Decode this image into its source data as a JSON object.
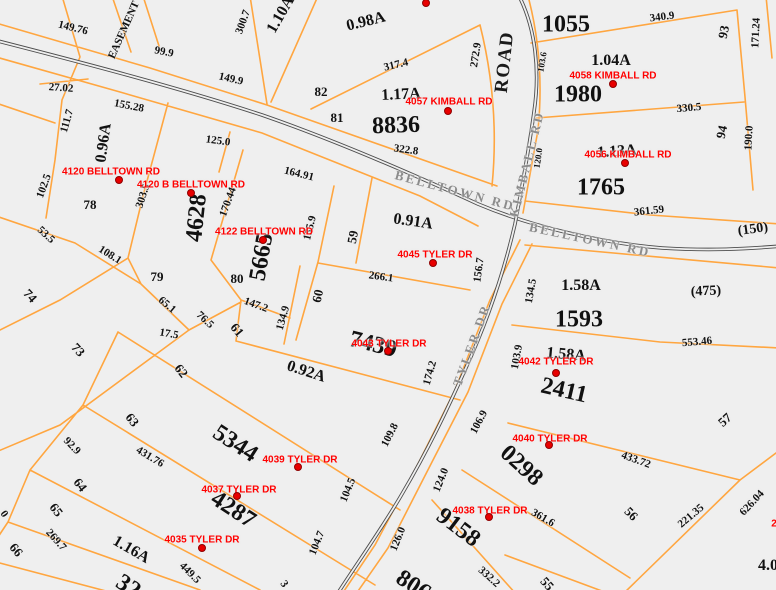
{
  "title": "Parcel tax map",
  "map": {
    "background": "#efefef",
    "colors": {
      "parcel_line": "#ffa640",
      "road_line": "#4c4c4c",
      "road_label": "#8c8c8c",
      "address": "#ff0000",
      "label": "#111111"
    },
    "road_names": [
      "BELLTOWN RD",
      "KIMBALL RD",
      "TYLER DR",
      "ROAD"
    ],
    "labels": [
      {
        "t": "149.76",
        "x": 73,
        "y": 28,
        "r": 14,
        "k": "dim"
      },
      {
        "t": "EASEMENT",
        "x": 124,
        "y": 30,
        "r": -66,
        "k": "dim"
      },
      {
        "t": "99.9",
        "x": 164,
        "y": 52,
        "r": 11,
        "k": "dim"
      },
      {
        "t": "149.9",
        "x": 231,
        "y": 79,
        "r": 13,
        "k": "dim"
      },
      {
        "t": "27.02",
        "x": 61,
        "y": 88,
        "r": 4,
        "k": "dim"
      },
      {
        "t": "155.28",
        "x": 129,
        "y": 106,
        "r": 11,
        "k": "dim"
      },
      {
        "t": "111.7",
        "x": 67,
        "y": 121,
        "r": -74,
        "k": "dim"
      },
      {
        "t": "0.96A",
        "x": 104,
        "y": 143,
        "r": -82,
        "k": "acre"
      },
      {
        "t": "125.0",
        "x": 218,
        "y": 141,
        "r": 8,
        "k": "dim"
      },
      {
        "t": "102.5",
        "x": 44,
        "y": 186,
        "r": -70,
        "k": "dim"
      },
      {
        "t": "300.7",
        "x": 243,
        "y": 22,
        "r": -70,
        "k": "dim"
      },
      {
        "t": "1.10A",
        "x": 281,
        "y": 15,
        "r": -60,
        "k": "acre"
      },
      {
        "t": "0.98A",
        "x": 366,
        "y": 22,
        "r": -14,
        "k": "acre"
      },
      {
        "t": "317.4",
        "x": 396,
        "y": 65,
        "r": -13,
        "k": "dim"
      },
      {
        "t": "272.9",
        "x": 476,
        "y": 55,
        "r": -81,
        "k": "dim"
      },
      {
        "t": "ROAD",
        "x": 505,
        "y": 62,
        "r": -84,
        "k": "roadbig"
      },
      {
        "t": "82",
        "x": 321,
        "y": 92,
        "r": 0,
        "k": "lot"
      },
      {
        "t": "1.17A",
        "x": 401,
        "y": 95,
        "r": -3,
        "k": "acre"
      },
      {
        "t": "81",
        "x": 337,
        "y": 118,
        "r": 0,
        "k": "lot"
      },
      {
        "t": "8836",
        "x": 396,
        "y": 126,
        "r": -2,
        "k": "parcel"
      },
      {
        "t": "322.8",
        "x": 406,
        "y": 150,
        "r": 8,
        "k": "dim"
      },
      {
        "t": "164.91",
        "x": 299,
        "y": 174,
        "r": 14,
        "k": "dim"
      },
      {
        "t": "BELLTOWN RD",
        "x": 455,
        "y": 191,
        "r": 15,
        "k": "road"
      },
      {
        "t": "1055",
        "x": 566,
        "y": 25,
        "r": 0,
        "k": "parcel"
      },
      {
        "t": "340.9",
        "x": 662,
        "y": 17,
        "r": -7,
        "k": "dim"
      },
      {
        "t": "93",
        "x": 724,
        "y": 32,
        "r": -78,
        "k": "lot"
      },
      {
        "t": "171.24",
        "x": 756,
        "y": 33,
        "r": -87,
        "k": "dim"
      },
      {
        "t": "1.04A",
        "x": 611,
        "y": 61,
        "r": 0,
        "k": "acre"
      },
      {
        "t": "1980",
        "x": 578,
        "y": 95,
        "r": 0,
        "k": "parcel"
      },
      {
        "t": "330.5",
        "x": 689,
        "y": 108,
        "r": -5,
        "k": "dim"
      },
      {
        "t": "103.6",
        "x": 542,
        "y": 62,
        "r": -80,
        "k": "dimsm"
      },
      {
        "t": "94",
        "x": 722,
        "y": 132,
        "r": -78,
        "k": "lot"
      },
      {
        "t": "190.0",
        "x": 749,
        "y": 138,
        "r": -87,
        "k": "dim"
      },
      {
        "t": "1.13A",
        "x": 617,
        "y": 152,
        "r": -4,
        "k": "acre"
      },
      {
        "t": "1765",
        "x": 601,
        "y": 188,
        "r": 0,
        "k": "parcel"
      },
      {
        "t": "KIMBALL RD",
        "x": 527,
        "y": 164,
        "r": -76,
        "k": "road"
      },
      {
        "t": "120.0",
        "x": 538,
        "y": 158,
        "r": -82,
        "k": "dimsm"
      },
      {
        "t": "361.59",
        "x": 649,
        "y": 211,
        "r": -6,
        "k": "dim"
      },
      {
        "t": "BELLTOWN RD",
        "x": 590,
        "y": 240,
        "r": 12,
        "k": "road"
      },
      {
        "t": "(150)",
        "x": 753,
        "y": 230,
        "r": -8,
        "k": "paren"
      },
      {
        "t": "78",
        "x": 90,
        "y": 205,
        "r": 0,
        "k": "lot"
      },
      {
        "t": "303.5",
        "x": 143,
        "y": 196,
        "r": -72,
        "k": "dim"
      },
      {
        "t": "4628",
        "x": 197,
        "y": 218,
        "r": -84,
        "k": "parcel"
      },
      {
        "t": "170.44",
        "x": 228,
        "y": 202,
        "r": -70,
        "k": "dim"
      },
      {
        "t": "53.5",
        "x": 46,
        "y": 235,
        "r": 42,
        "k": "dim"
      },
      {
        "t": "108.1",
        "x": 110,
        "y": 255,
        "r": 32,
        "k": "dim"
      },
      {
        "t": "79",
        "x": 157,
        "y": 277,
        "r": 0,
        "k": "lot"
      },
      {
        "t": "74",
        "x": 30,
        "y": 296,
        "r": 48,
        "k": "lot"
      },
      {
        "t": "80",
        "x": 237,
        "y": 279,
        "r": 0,
        "k": "lot"
      },
      {
        "t": "5665",
        "x": 262,
        "y": 257,
        "r": -80,
        "k": "parcel"
      },
      {
        "t": "155.9",
        "x": 310,
        "y": 228,
        "r": -76,
        "k": "dim"
      },
      {
        "t": "59",
        "x": 353,
        "y": 237,
        "r": -80,
        "k": "lot"
      },
      {
        "t": "0.91A",
        "x": 413,
        "y": 222,
        "r": 8,
        "k": "acre"
      },
      {
        "t": "156.7",
        "x": 479,
        "y": 270,
        "r": -82,
        "k": "dim"
      },
      {
        "t": "266.1",
        "x": 381,
        "y": 277,
        "r": 8,
        "k": "dim"
      },
      {
        "t": "147.2",
        "x": 256,
        "y": 305,
        "r": 20,
        "k": "dim"
      },
      {
        "t": "134.9",
        "x": 283,
        "y": 318,
        "r": -74,
        "k": "dim"
      },
      {
        "t": "60",
        "x": 318,
        "y": 296,
        "r": -78,
        "k": "lot"
      },
      {
        "t": "65.1",
        "x": 167,
        "y": 305,
        "r": 40,
        "k": "dim"
      },
      {
        "t": "76.5",
        "x": 205,
        "y": 320,
        "r": 43,
        "k": "dim"
      },
      {
        "t": "17.5",
        "x": 169,
        "y": 334,
        "r": 10,
        "k": "dim"
      },
      {
        "t": "61",
        "x": 237,
        "y": 330,
        "r": 50,
        "k": "lot"
      },
      {
        "t": "73",
        "x": 78,
        "y": 350,
        "r": 48,
        "k": "lot"
      },
      {
        "t": "62",
        "x": 181,
        "y": 371,
        "r": 52,
        "k": "lot"
      },
      {
        "t": "7439",
        "x": 373,
        "y": 345,
        "r": 14,
        "k": "parcel"
      },
      {
        "t": "174.2",
        "x": 430,
        "y": 373,
        "r": -74,
        "k": "dim"
      },
      {
        "t": "TYLER DR",
        "x": 472,
        "y": 345,
        "r": -70,
        "k": "road"
      },
      {
        "t": "0.92A",
        "x": 306,
        "y": 372,
        "r": 18,
        "k": "acre"
      },
      {
        "t": "134.5",
        "x": 531,
        "y": 291,
        "r": -80,
        "k": "dim"
      },
      {
        "t": "1.58A",
        "x": 581,
        "y": 286,
        "r": 0,
        "k": "acre"
      },
      {
        "t": "(475)",
        "x": 706,
        "y": 292,
        "r": -3,
        "k": "paren"
      },
      {
        "t": "1593",
        "x": 579,
        "y": 320,
        "r": 0,
        "k": "parcel"
      },
      {
        "t": "553.46",
        "x": 697,
        "y": 342,
        "r": -5,
        "k": "dim"
      },
      {
        "t": "103.9",
        "x": 517,
        "y": 357,
        "r": -80,
        "k": "dim"
      },
      {
        "t": "1.58A",
        "x": 566,
        "y": 355,
        "r": 5,
        "k": "acre"
      },
      {
        "t": "2411",
        "x": 564,
        "y": 391,
        "r": 13,
        "k": "parcel"
      },
      {
        "t": "63",
        "x": 132,
        "y": 420,
        "r": 52,
        "k": "lot"
      },
      {
        "t": "92.9",
        "x": 72,
        "y": 446,
        "r": 46,
        "k": "dim"
      },
      {
        "t": "431.76",
        "x": 150,
        "y": 457,
        "r": 31,
        "k": "dim"
      },
      {
        "t": "5344",
        "x": 235,
        "y": 444,
        "r": 33,
        "k": "parcel"
      },
      {
        "t": "64",
        "x": 80,
        "y": 485,
        "r": 52,
        "k": "lot"
      },
      {
        "t": "104.5",
        "x": 348,
        "y": 490,
        "r": -68,
        "k": "dim"
      },
      {
        "t": "109.8",
        "x": 390,
        "y": 435,
        "r": -63,
        "k": "dim"
      },
      {
        "t": "4287",
        "x": 233,
        "y": 510,
        "r": 33,
        "k": "parcel"
      },
      {
        "t": "65",
        "x": 56,
        "y": 510,
        "r": 52,
        "k": "lot"
      },
      {
        "t": "269.7",
        "x": 56,
        "y": 540,
        "r": 48,
        "k": "dim"
      },
      {
        "t": "66",
        "x": 16,
        "y": 550,
        "r": 50,
        "k": "lot"
      },
      {
        "t": "1.16A",
        "x": 131,
        "y": 550,
        "r": 30,
        "k": "acre"
      },
      {
        "t": "449.5",
        "x": 190,
        "y": 573,
        "r": 45,
        "k": "dim"
      },
      {
        "t": "104.7",
        "x": 317,
        "y": 543,
        "r": -68,
        "k": "dim"
      },
      {
        "t": "106.9",
        "x": 479,
        "y": 422,
        "r": -62,
        "k": "dim"
      },
      {
        "t": "124.0",
        "x": 441,
        "y": 480,
        "r": -68,
        "k": "dim"
      },
      {
        "t": "0298",
        "x": 521,
        "y": 466,
        "r": 42,
        "k": "parcel"
      },
      {
        "t": "9158",
        "x": 458,
        "y": 528,
        "r": 37,
        "k": "parcel"
      },
      {
        "t": "126.0",
        "x": 398,
        "y": 539,
        "r": -68,
        "k": "dim"
      },
      {
        "t": "332.2",
        "x": 489,
        "y": 577,
        "r": 42,
        "k": "dim"
      },
      {
        "t": "57",
        "x": 725,
        "y": 420,
        "r": -42,
        "k": "lot"
      },
      {
        "t": "433.72",
        "x": 636,
        "y": 460,
        "r": 20,
        "k": "dim"
      },
      {
        "t": "361.6",
        "x": 543,
        "y": 518,
        "r": 30,
        "k": "dim"
      },
      {
        "t": "56",
        "x": 631,
        "y": 514,
        "r": 45,
        "k": "lot"
      },
      {
        "t": "221.35",
        "x": 691,
        "y": 516,
        "r": -40,
        "k": "dim"
      },
      {
        "t": "626.04",
        "x": 752,
        "y": 503,
        "r": -47,
        "k": "dim"
      },
      {
        "t": "55",
        "x": 547,
        "y": 584,
        "r": 48,
        "k": "lot"
      },
      {
        "t": "4.0",
        "x": 768,
        "y": 566,
        "r": 0,
        "k": "acre"
      },
      {
        "t": "806",
        "x": 413,
        "y": 586,
        "r": 33,
        "k": "parcel"
      },
      {
        "t": "32",
        "x": 128,
        "y": 587,
        "r": 33,
        "k": "parcel"
      },
      {
        "t": "3",
        "x": 284,
        "y": 584,
        "r": 55,
        "k": "dim"
      },
      {
        "t": "0",
        "x": 4,
        "y": 514,
        "r": 55,
        "k": "dim"
      }
    ],
    "addresses": [
      {
        "t": "4120 BELLTOWN RD",
        "x": 111,
        "y": 172,
        "dx": 119,
        "dy": 180
      },
      {
        "t": "4120 B BELLTOWN RD",
        "x": 191,
        "y": 185,
        "dx": 191,
        "dy": 193
      },
      {
        "t": "4122 BELLTOWN RD",
        "x": 264,
        "y": 232,
        "dx": 263,
        "dy": 240
      },
      {
        "t": "4057 KIMBALL RD",
        "x": 449,
        "y": 102,
        "dx": 448,
        "dy": 111
      },
      {
        "t": "4058 KIMBALL RD",
        "x": 613,
        "y": 76,
        "dx": 613,
        "dy": 84
      },
      {
        "t": "4056 KIMBALL RD",
        "x": 628,
        "y": 155,
        "dx": 625,
        "dy": 163
      },
      {
        "t": "4045 TYLER DR",
        "x": 435,
        "y": 255,
        "dx": 433,
        "dy": 263
      },
      {
        "t": "4043 TYLER DR",
        "x": 389,
        "y": 344,
        "dx": 388,
        "dy": 351
      },
      {
        "t": "4042 TYLER DR",
        "x": 556,
        "y": 362,
        "dx": 556,
        "dy": 373
      },
      {
        "t": "4040 TYLER DR",
        "x": 550,
        "y": 439,
        "dx": 549,
        "dy": 445
      },
      {
        "t": "4039 TYLER DR",
        "x": 300,
        "y": 460,
        "dx": 298,
        "dy": 467
      },
      {
        "t": "4038 TYLER DR",
        "x": 490,
        "y": 511,
        "dx": 489,
        "dy": 517
      },
      {
        "t": "4037 TYLER DR",
        "x": 239,
        "y": 490,
        "dx": 237,
        "dy": 496
      },
      {
        "t": "4035 TYLER DR",
        "x": 202,
        "y": 540,
        "dx": 202,
        "dy": 548
      },
      {
        "t": "2",
        "x": 774,
        "y": 524
      }
    ],
    "stray_dots": [
      {
        "x": 426,
        "y": 3
      }
    ]
  }
}
